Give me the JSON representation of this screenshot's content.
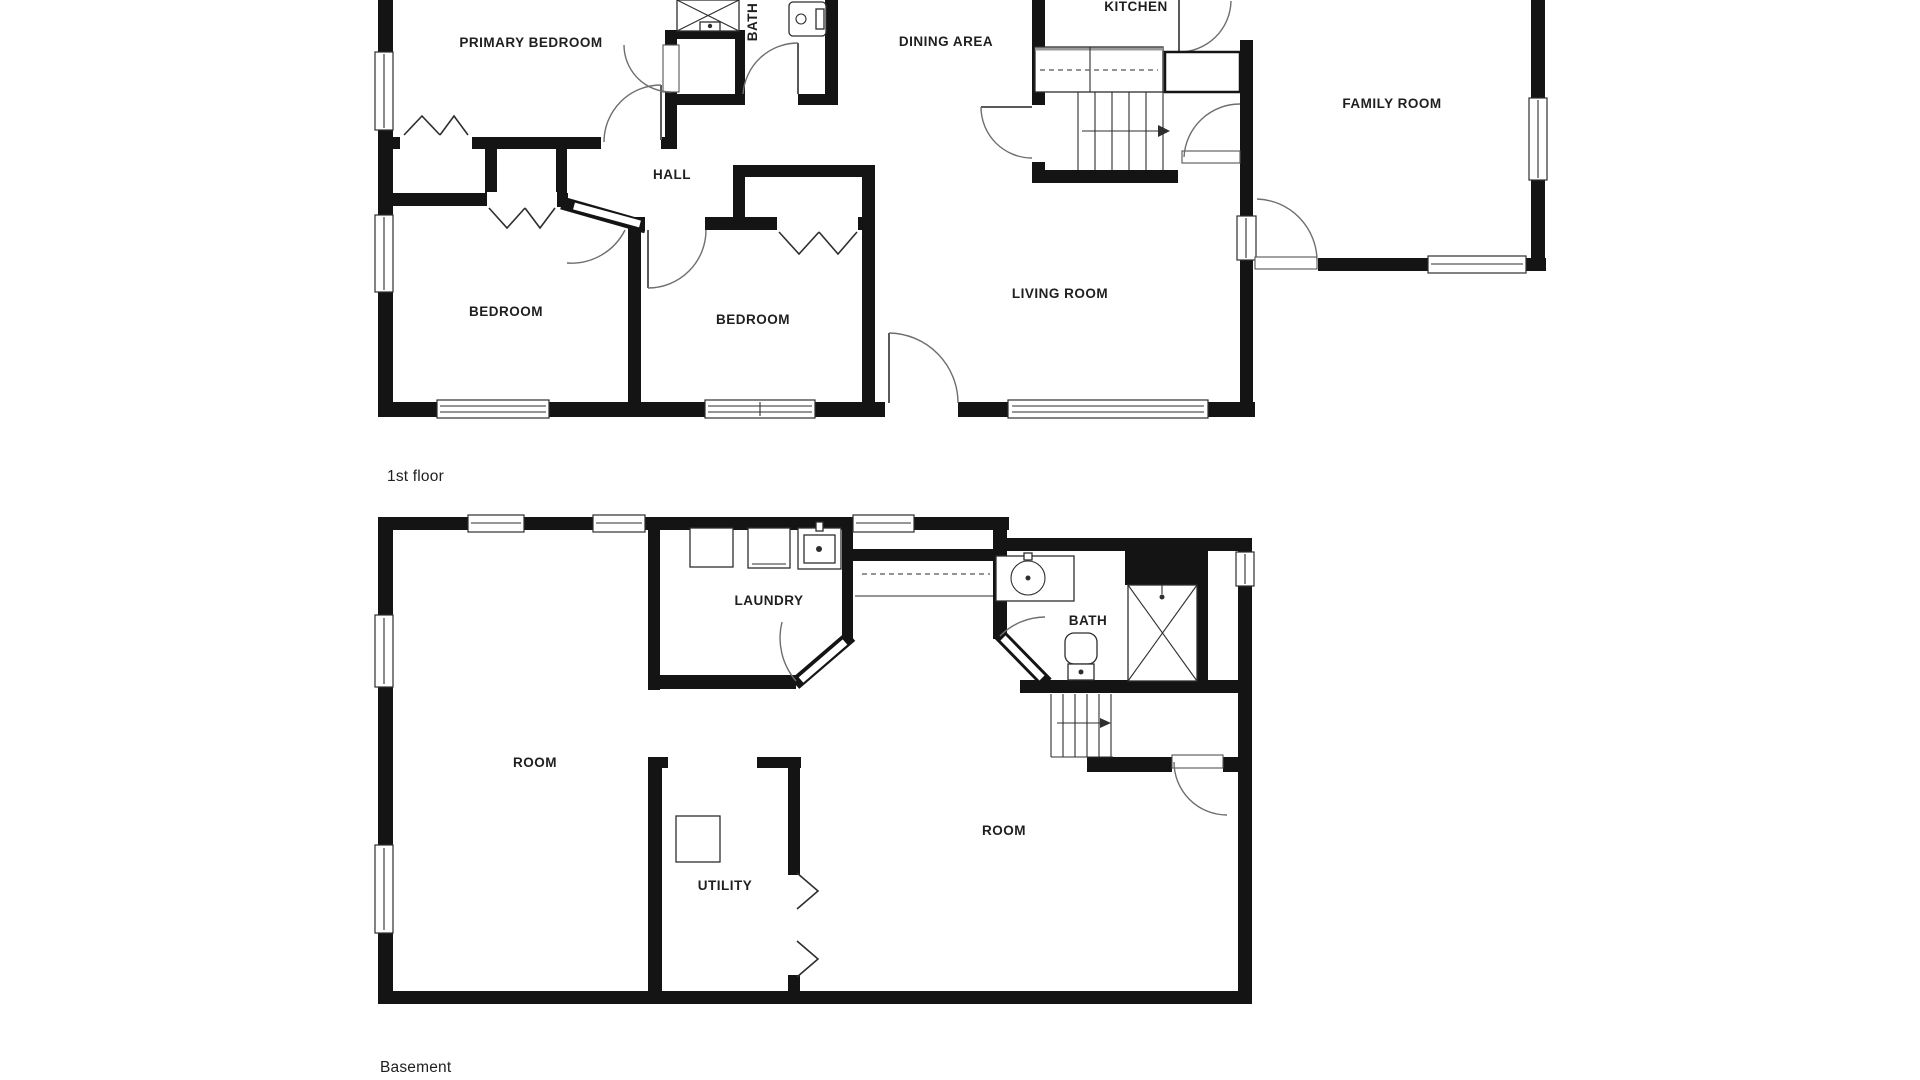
{
  "document": {
    "type": "floor-plan",
    "background": "#ffffff"
  },
  "colors": {
    "wall": "#141414",
    "line": "#2e2e2e",
    "door_arc": "#6e6e6e",
    "text": "#1f1f1f"
  },
  "floors": [
    {
      "id": "first-floor",
      "label": "1st floor",
      "room_labels": [
        {
          "id": "primary-bedroom",
          "text": "PRIMARY BEDROOM"
        },
        {
          "id": "bath",
          "text": "BATH"
        },
        {
          "id": "dining-area",
          "text": "DINING AREA"
        },
        {
          "id": "kitchen",
          "text": "KITCHEN"
        },
        {
          "id": "family-room",
          "text": "FAMILY ROOM"
        },
        {
          "id": "hall",
          "text": "HALL"
        },
        {
          "id": "bedroom-left",
          "text": "BEDROOM"
        },
        {
          "id": "bedroom-middle",
          "text": "BEDROOM"
        },
        {
          "id": "living-room",
          "text": "LIVING ROOM"
        }
      ]
    },
    {
      "id": "basement",
      "label": "Basement",
      "room_labels": [
        {
          "id": "laundry",
          "text": "LAUNDRY"
        },
        {
          "id": "bath",
          "text": "BATH"
        },
        {
          "id": "room-left",
          "text": "ROOM"
        },
        {
          "id": "utility",
          "text": "UTILITY"
        },
        {
          "id": "room-right",
          "text": "ROOM"
        }
      ]
    }
  ]
}
